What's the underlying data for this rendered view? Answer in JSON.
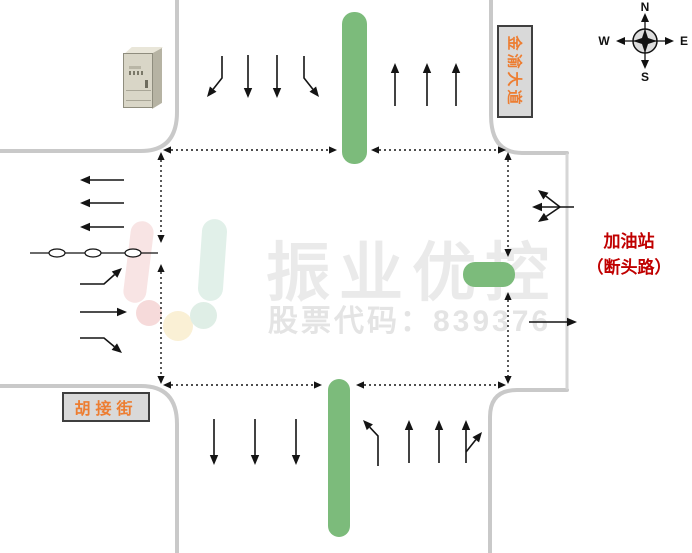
{
  "compass": {
    "north": "N",
    "south": "S",
    "east": "E",
    "west": "W"
  },
  "road_labels": {
    "north_road": "金渝大道",
    "west_road": "胡接街"
  },
  "annotations": {
    "east_note_line1": "加油站",
    "east_note_line2": "（断头路）"
  },
  "watermark": {
    "brand": "振业优控",
    "stock_code": "股票代码：839376"
  },
  "equipment": {
    "signal_cabinet": "signal-controller-cabinet"
  },
  "colors": {
    "median_green": "#7CBB7B",
    "road_gray": "#C9C9C9",
    "label_orange": "#ED7D31",
    "note_red": "#C00000",
    "watermark_gray": "#EAEAEA",
    "watermark_gray2": "#E4E4E4",
    "arrow_black": "#141414"
  },
  "movements": {
    "north_approach_southbound": [
      "left",
      "through",
      "through",
      "right"
    ],
    "north_exit_northbound": [
      "through",
      "through",
      "through"
    ],
    "west_exit_westbound": [
      "through",
      "through",
      "through"
    ],
    "west_approach_eastbound": [
      "left",
      "through",
      "right"
    ],
    "east_deadend_approach": [
      "left",
      "through",
      "right"
    ],
    "east_exit_eastbound": [
      "through"
    ],
    "south_exit_southbound": [
      "through",
      "through",
      "through"
    ],
    "south_approach_northbound": [
      "left",
      "through",
      "through",
      "through-right"
    ]
  },
  "geometry": {
    "medians": [
      {
        "id": "median-north",
        "x": 342,
        "y": 12,
        "w": 25,
        "h": 152,
        "r": 12
      },
      {
        "id": "median-south",
        "x": 328,
        "y": 379,
        "w": 22,
        "h": 158,
        "r": 11
      },
      {
        "id": "median-east",
        "x": 463,
        "y": 262,
        "w": 52,
        "h": 25,
        "r": 12
      }
    ],
    "dotted_segments": [
      {
        "id": "box-top-left",
        "pts": [
          [
            163,
            150
          ],
          [
            337,
            150
          ]
        ]
      },
      {
        "id": "box-top-right",
        "pts": [
          [
            371,
            150
          ],
          [
            506,
            150
          ]
        ]
      },
      {
        "id": "box-west-upper",
        "pts": [
          [
            161,
            152
          ],
          [
            161,
            243
          ]
        ]
      },
      {
        "id": "box-west-lower",
        "pts": [
          [
            161,
            264
          ],
          [
            161,
            384
          ]
        ]
      },
      {
        "id": "box-east-upper",
        "pts": [
          [
            508,
            152
          ],
          [
            508,
            257
          ]
        ]
      },
      {
        "id": "box-east-lower",
        "pts": [
          [
            508,
            292
          ],
          [
            508,
            384
          ]
        ]
      },
      {
        "id": "box-bottom-left",
        "pts": [
          [
            163,
            385
          ],
          [
            322,
            385
          ]
        ]
      },
      {
        "id": "box-bottom-right",
        "pts": [
          [
            356,
            385
          ],
          [
            506,
            385
          ]
        ]
      }
    ],
    "lane_arrows": [
      {
        "id": "north-approach-left",
        "pts": [
          [
            222,
            56
          ],
          [
            222,
            78
          ],
          [
            207,
            97
          ]
        ]
      },
      {
        "id": "north-approach-thru-1",
        "pts": [
          [
            248,
            55
          ],
          [
            248,
            98
          ]
        ]
      },
      {
        "id": "north-approach-thru-2",
        "pts": [
          [
            277,
            55
          ],
          [
            277,
            98
          ]
        ]
      },
      {
        "id": "north-approach-right",
        "pts": [
          [
            304,
            56
          ],
          [
            304,
            78
          ],
          [
            319,
            97
          ]
        ]
      },
      {
        "id": "north-exit-1",
        "pts": [
          [
            395,
            106
          ],
          [
            395,
            63
          ]
        ]
      },
      {
        "id": "north-exit-2",
        "pts": [
          [
            427,
            106
          ],
          [
            427,
            63
          ]
        ]
      },
      {
        "id": "north-exit-3",
        "pts": [
          [
            456,
            106
          ],
          [
            456,
            63
          ]
        ]
      },
      {
        "id": "west-exit-1",
        "pts": [
          [
            124,
            180
          ],
          [
            80,
            180
          ]
        ]
      },
      {
        "id": "west-exit-2",
        "pts": [
          [
            124,
            203
          ],
          [
            80,
            203
          ]
        ]
      },
      {
        "id": "west-exit-3",
        "pts": [
          [
            124,
            227
          ],
          [
            80,
            227
          ]
        ]
      },
      {
        "id": "west-approach-left",
        "pts": [
          [
            80,
            284
          ],
          [
            104,
            284
          ],
          [
            122,
            268
          ]
        ]
      },
      {
        "id": "west-approach-thru",
        "pts": [
          [
            80,
            312
          ],
          [
            127,
            312
          ]
        ]
      },
      {
        "id": "west-approach-right",
        "pts": [
          [
            80,
            338
          ],
          [
            104,
            338
          ],
          [
            122,
            353
          ]
        ]
      },
      {
        "id": "east-deadend-thru",
        "pts": [
          [
            574,
            207
          ],
          [
            532,
            207
          ]
        ]
      },
      {
        "id": "east-deadend-up",
        "pts": [
          [
            560,
            207
          ],
          [
            538,
            190
          ]
        ]
      },
      {
        "id": "east-deadend-down",
        "pts": [
          [
            560,
            207
          ],
          [
            538,
            222
          ]
        ]
      },
      {
        "id": "east-exit",
        "pts": [
          [
            529,
            322
          ],
          [
            577,
            322
          ]
        ]
      },
      {
        "id": "south-exit-1",
        "pts": [
          [
            214,
            419
          ],
          [
            214,
            465
          ]
        ]
      },
      {
        "id": "south-exit-2",
        "pts": [
          [
            255,
            419
          ],
          [
            255,
            465
          ]
        ]
      },
      {
        "id": "south-exit-3",
        "pts": [
          [
            296,
            419
          ],
          [
            296,
            465
          ]
        ]
      },
      {
        "id": "south-approach-left",
        "pts": [
          [
            378,
            466
          ],
          [
            378,
            436
          ],
          [
            363,
            420
          ]
        ]
      },
      {
        "id": "south-approach-thru-1",
        "pts": [
          [
            409,
            463
          ],
          [
            409,
            420
          ]
        ]
      },
      {
        "id": "south-approach-thru-2",
        "pts": [
          [
            439,
            463
          ],
          [
            439,
            420
          ]
        ]
      },
      {
        "id": "south-approach-thru-3",
        "pts": [
          [
            466,
            463
          ],
          [
            466,
            420
          ]
        ]
      },
      {
        "id": "south-approach-right-branch",
        "pts": [
          [
            466,
            452
          ],
          [
            482,
            432
          ]
        ]
      }
    ],
    "chain_line": {
      "x1": 30,
      "y1": 253,
      "x2": 158,
      "y2": 253,
      "ellipse_cx": [
        57,
        93,
        133
      ],
      "rx": 8,
      "ry": 4
    }
  }
}
